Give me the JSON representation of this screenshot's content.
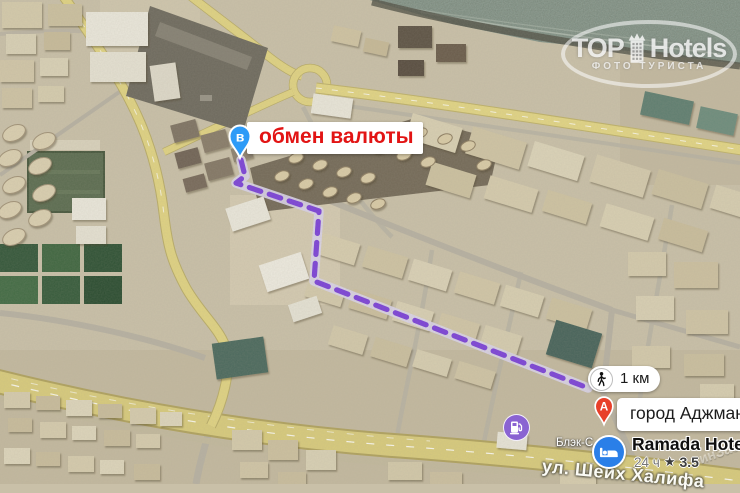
{
  "watermark": {
    "top": "TOP",
    "bottom": "Hotels",
    "tagline": "ФОТО ТУРИСТА"
  },
  "origin": {
    "pin": "в",
    "label": "обмен валюты"
  },
  "distance": {
    "label": "1 км"
  },
  "destination": {
    "pin": "A",
    "label": "город Аджман"
  },
  "hotel": {
    "name": "Ramada Hotel &",
    "hours": "24 ч",
    "star": "★",
    "rating": "3.5"
  },
  "map": {
    "street": "ул. Шейх Халифа",
    "street_fragment": "инЗае",
    "poi_small": "Блэк-С"
  },
  "colors": {
    "route": "#7b41d8",
    "origin_pin": "#2e9bf7",
    "destination_pin": "#e8402a",
    "hotel_icon": "#2a7fe8",
    "fuel_icon": "#8a63d2",
    "origin_text": "#e21414"
  }
}
